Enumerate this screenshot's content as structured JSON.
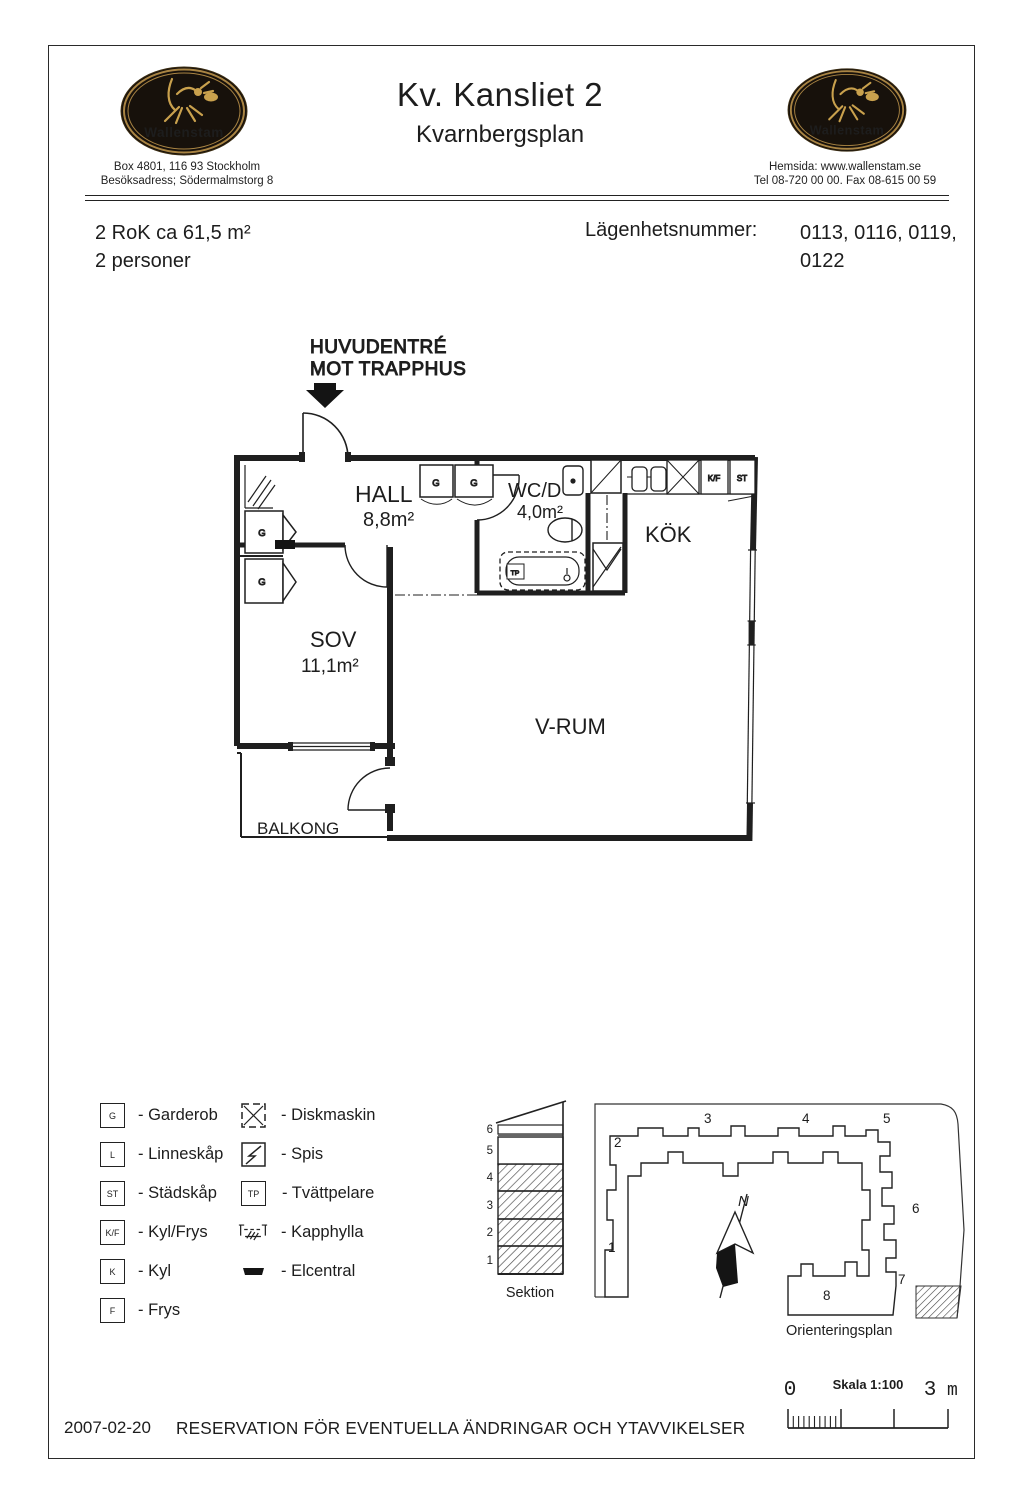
{
  "header": {
    "logo_text": "Wallenstam",
    "left_address_line1": "Box 4801, 116 93 Stockholm",
    "left_address_line2": "Besöksadress; Södermalmstorg 8",
    "title": "Kv. Kansliet 2",
    "subtitle": "Kvarnbergsplan",
    "right_info_line1": "Hemsida: www.wallenstam.se",
    "right_info_line2": "Tel 08-720 00 00. Fax 08-615 00 59"
  },
  "apartment": {
    "size_line": "2 RoK ca 61,5 m²",
    "persons_line": "2 personer",
    "number_label": "Lägenhetsnummer:",
    "numbers_line1": "0113, 0116, 0119,",
    "numbers_line2": "0122"
  },
  "plan": {
    "entrance_line1": "HUVUDENTRÉ",
    "entrance_line2": "MOT TRAPPHUS",
    "rooms": {
      "hall_name": "HALL",
      "hall_area": "8,8m²",
      "wcd_name": "WC/D",
      "wcd_area": "4,0m²",
      "kok": "KÖK",
      "sov_name": "SOV",
      "sov_area": "11,1m²",
      "vrum": "V-RUM",
      "balkong": "BALKONG"
    },
    "fixtures": {
      "g": "G",
      "kf": "K/F",
      "st": "ST",
      "tp": "TP"
    }
  },
  "legend": {
    "left": [
      {
        "symbol": "G",
        "label": "- Garderob"
      },
      {
        "symbol": "L",
        "label": "- Linneskåp"
      },
      {
        "symbol": "ST",
        "label": "- Städskåp"
      },
      {
        "symbol": "K/F",
        "label": "- Kyl/Frys"
      },
      {
        "symbol": "K",
        "label": "- Kyl"
      },
      {
        "symbol": "F",
        "label": "- Frys"
      }
    ],
    "right": [
      {
        "icon": "diskmaskin-icon",
        "label": "- Diskmaskin"
      },
      {
        "icon": "spis-icon",
        "label": "- Spis"
      },
      {
        "symbol": "TP",
        "label": "- Tvättpelare"
      },
      {
        "icon": "kapphylla-icon",
        "label": "- Kapphylla"
      },
      {
        "icon": "elcentral-icon",
        "label": "- Elcentral"
      }
    ]
  },
  "sektion": {
    "label": "Sektion",
    "floors": [
      "1",
      "2",
      "3",
      "4",
      "5",
      "6"
    ]
  },
  "orientering": {
    "label": "Orienteringsplan",
    "north": "N",
    "units": [
      "1",
      "2",
      "3",
      "4",
      "5",
      "6",
      "7",
      "8"
    ]
  },
  "scalebar": {
    "zero": "0",
    "title": "Skala 1:100",
    "end_value": "3",
    "unit": "m"
  },
  "footer": {
    "date": "2007-02-20",
    "text": "RESERVATION FÖR EVENTUELLA ÄNDRINGAR OCH YTAVVIKELSER"
  }
}
